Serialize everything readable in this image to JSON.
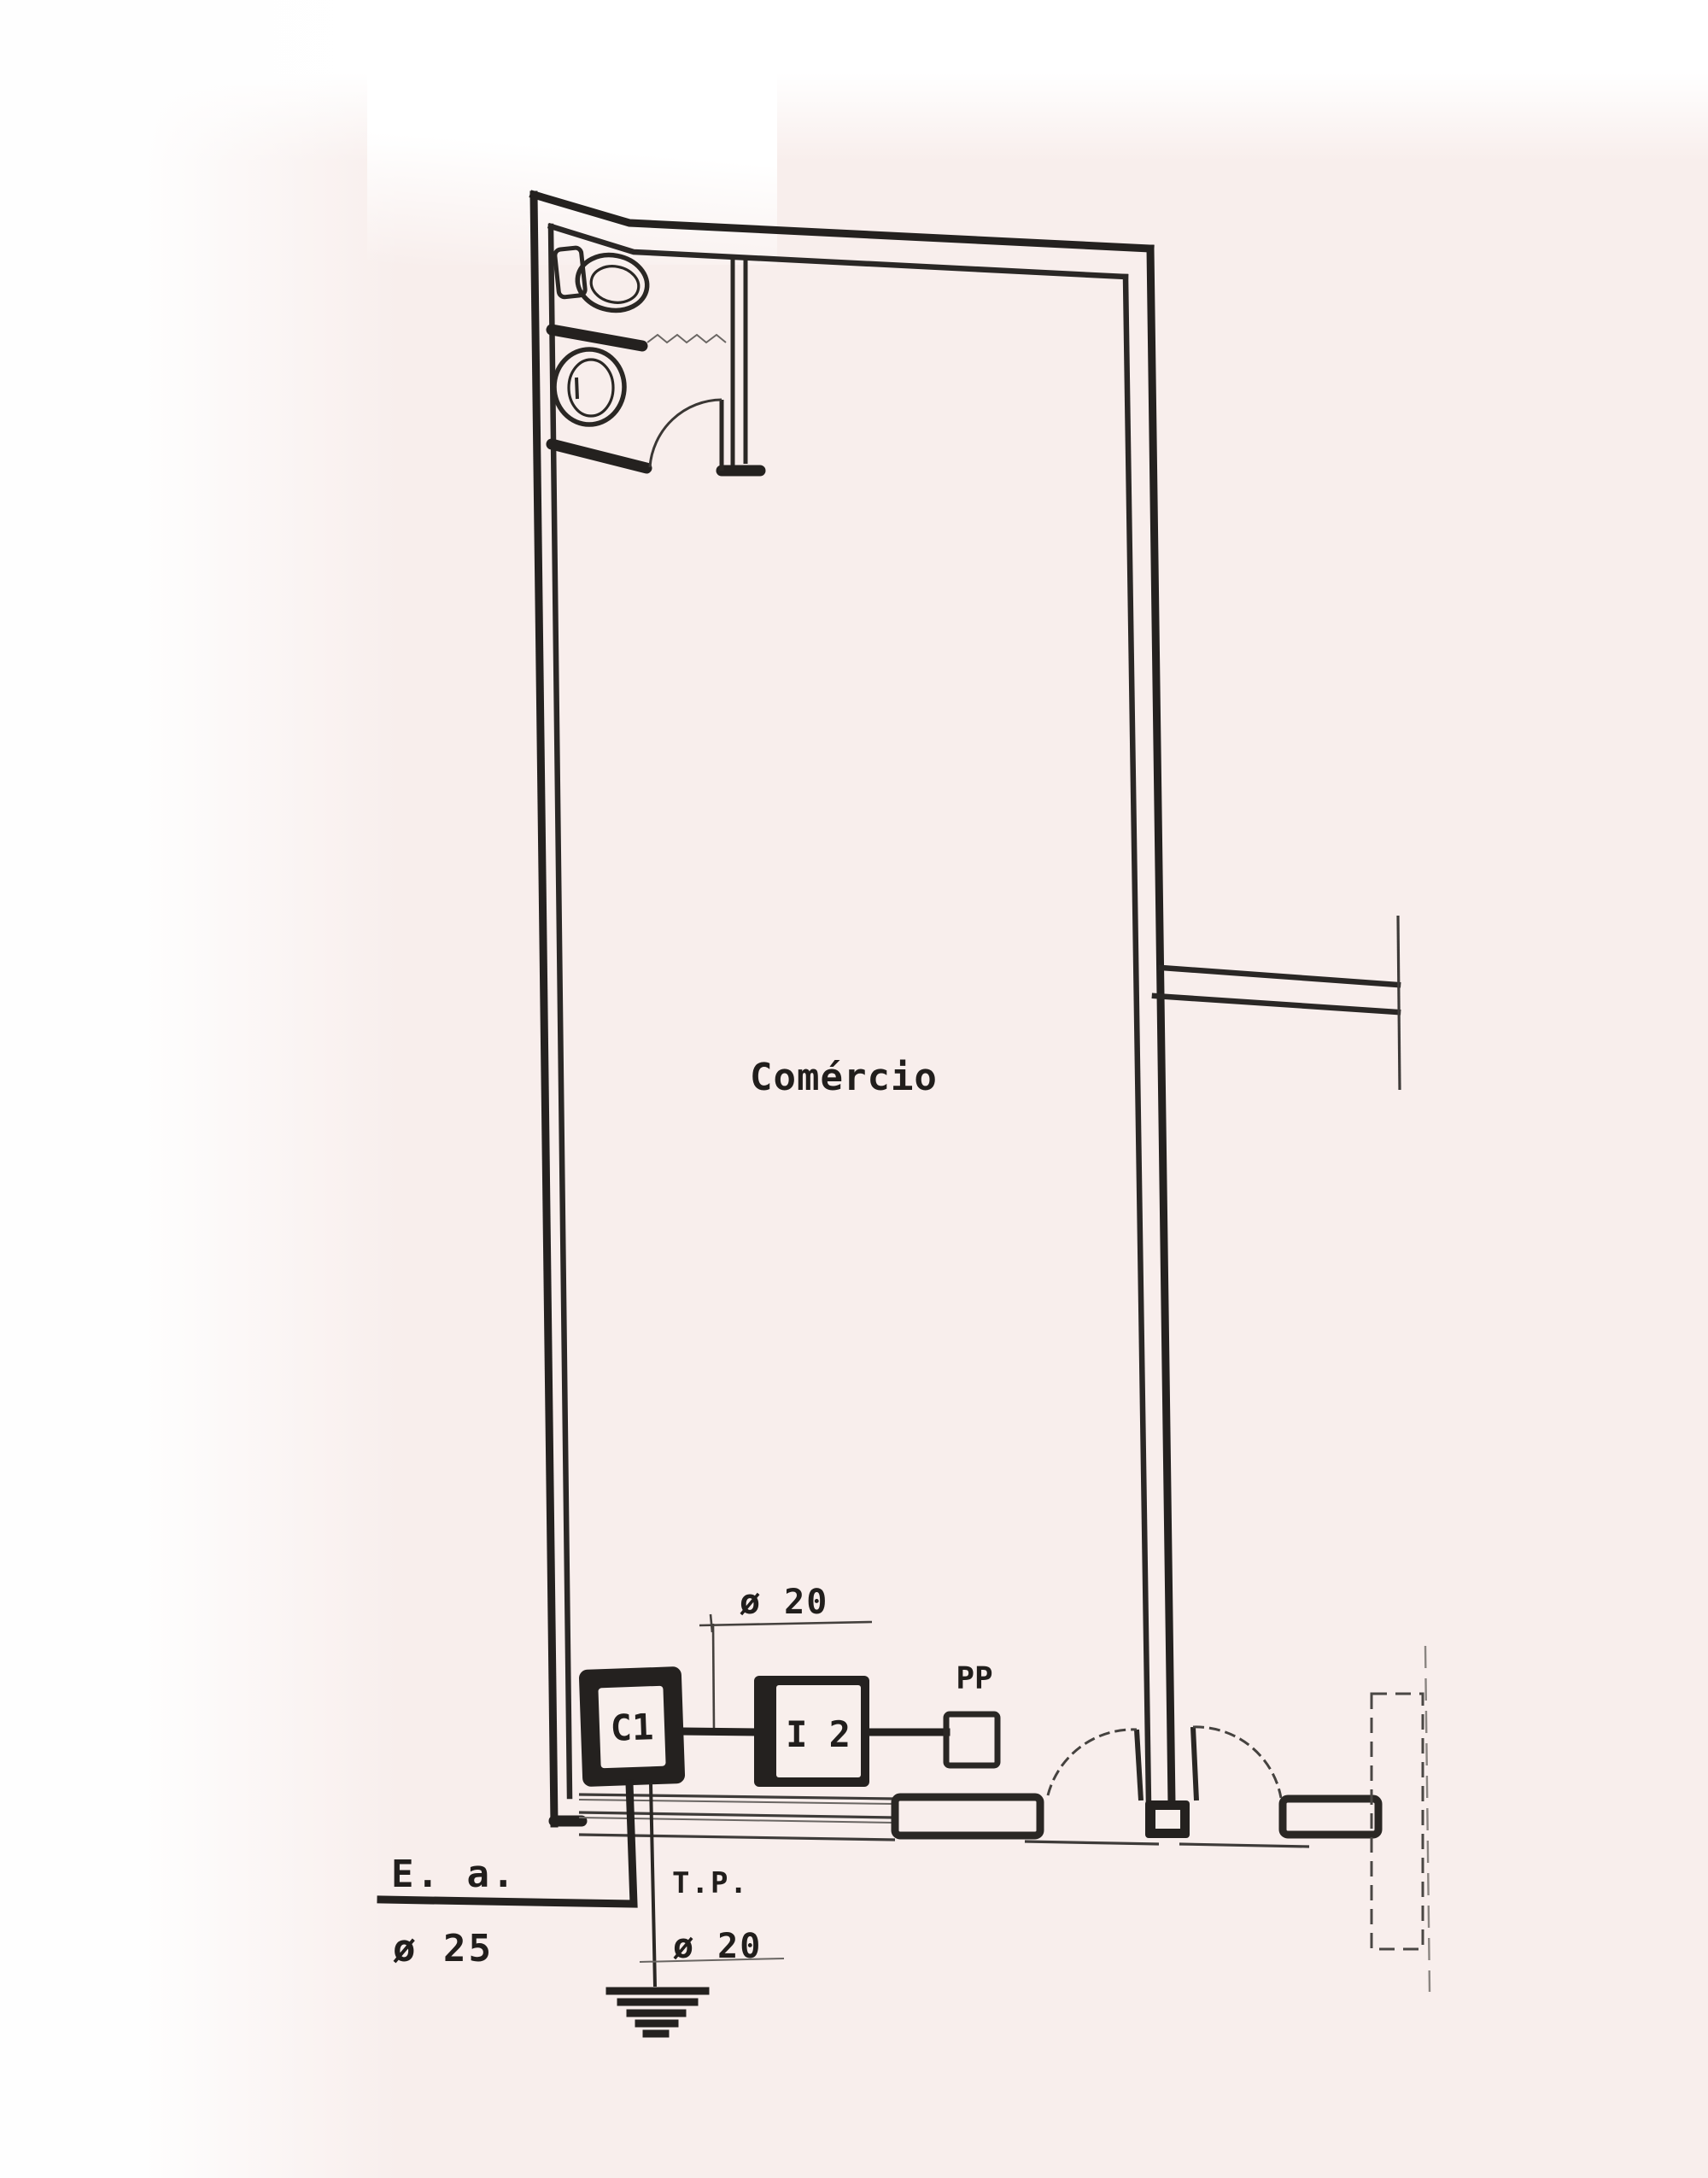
{
  "room": {
    "label": "Comércio"
  },
  "devices": {
    "c1": "C1",
    "i2": "I 2",
    "pp": "PP"
  },
  "annotations": {
    "feeder_diameter": "ø 20",
    "water_entry": "E. a.",
    "water_entry_diameter": "ø 25",
    "ground_tube": "T.P.",
    "ground_tube_diameter": "ø 20"
  },
  "colors": {
    "ink": "#24211f",
    "paper": "#f8eeec"
  }
}
